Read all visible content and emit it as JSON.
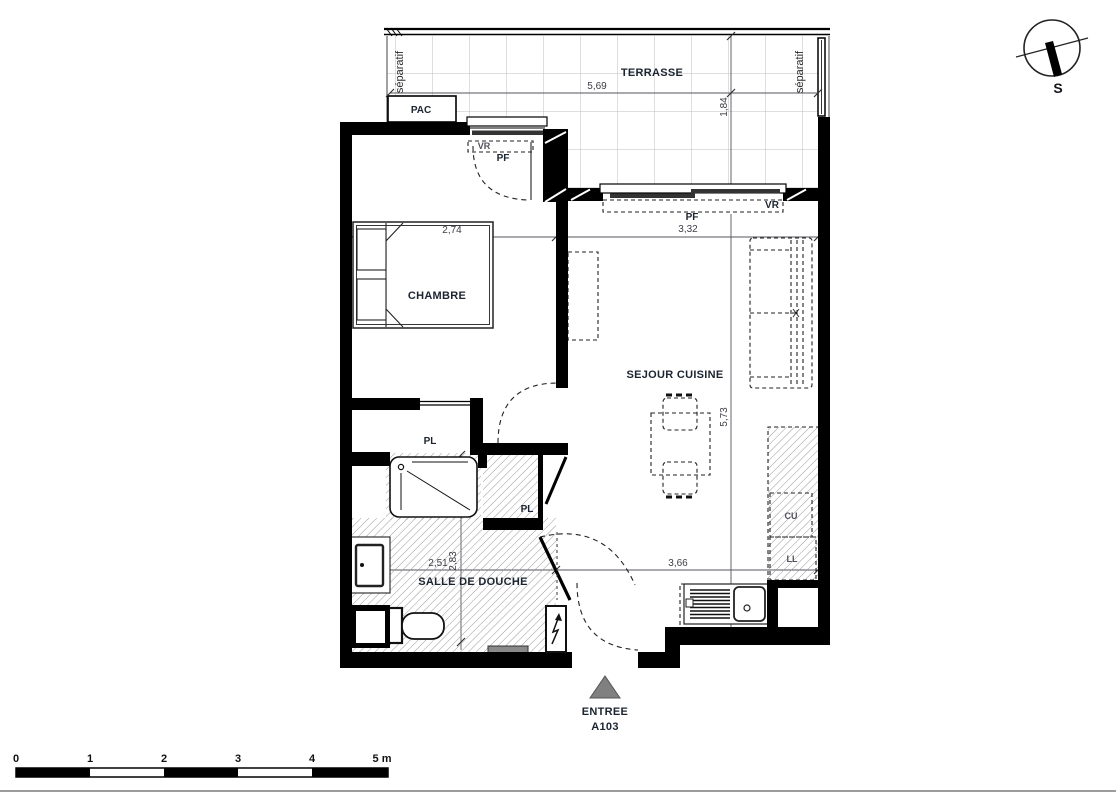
{
  "terrace": {
    "label": "TERRASSE",
    "separator_left": "séparatif",
    "separator_right": "séparatif",
    "dim_width": "5,69",
    "dim_depth": "1,84"
  },
  "equipment": {
    "pac": "PAC"
  },
  "windows": {
    "bedroom": {
      "vr": "VR",
      "pf": "PF"
    },
    "living": {
      "vr": "VR",
      "pf": "PF"
    }
  },
  "rooms": {
    "bedroom": {
      "label": "CHAMBRE",
      "dim_width": "2,74"
    },
    "living": {
      "label": "SEJOUR CUISINE",
      "dim_width": "3,32",
      "dim_height": "5,73"
    },
    "bathroom": {
      "label": "SALLE DE DOUCHE",
      "dim_width": "2,51",
      "dim_height": "2,83"
    },
    "hall": {
      "dim_width": "3,66"
    }
  },
  "closets": {
    "upper": "PL",
    "lower": "PL"
  },
  "kitchen": {
    "hob": "CU",
    "washer": "LL"
  },
  "entrance": {
    "label": "ENTREE",
    "unit": "A103"
  },
  "compass": {
    "south": "S"
  },
  "scale_bar": {
    "ticks": [
      "0",
      "1",
      "2",
      "3",
      "4"
    ],
    "end": "5 m"
  },
  "colors": {
    "wall": "#000000",
    "label": "#1b2430",
    "dimension": "#3d3d46",
    "entry_triangle": "#808080",
    "unit_number": "#1f4e79"
  }
}
